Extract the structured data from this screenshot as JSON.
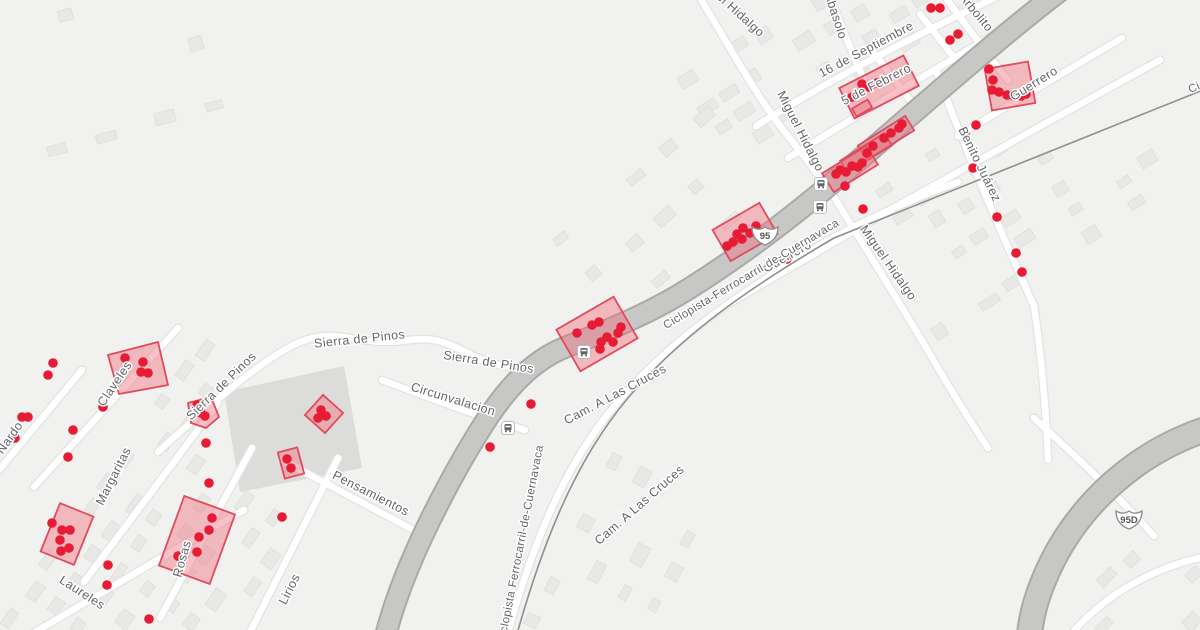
{
  "map": {
    "colors": {
      "land": "#f1f1f0",
      "building": "#e8e8e7",
      "building_stroke": "#dededc",
      "plaza": "#dcdcda",
      "minor": "#ffffff",
      "minor_casing": "#e3e3e1",
      "major": "#c7c7c6",
      "major_casing": "#a9a9a8",
      "rail": "#8f8f8e",
      "marker": "#e81b35",
      "highlight_fill": "#f0697a",
      "highlight_stroke": "#e24b5e",
      "label": "#63666a",
      "halo": "#ffffff",
      "shield_fill": "#ffffff",
      "shield_stroke": "#8f8f8f",
      "shield_text": "#555555",
      "bus_fill": "#ffffff",
      "bus_stroke": "#bdbdbd",
      "bus_glyph": "#5f6368"
    },
    "street_labels": [
      {
        "t": "Sierra de Pinos",
        "x": 224,
        "y": 389,
        "r": -44
      },
      {
        "t": "Sierra de Pinos",
        "x": 360,
        "y": 343,
        "r": -6
      },
      {
        "t": "Sierra de Pinos",
        "x": 488,
        "y": 366,
        "r": 9
      },
      {
        "t": "Circunvalacion",
        "x": 452,
        "y": 403,
        "r": 17
      },
      {
        "t": "Pensamientos",
        "x": 369,
        "y": 497,
        "r": 27
      },
      {
        "t": "Margaritas",
        "x": 117,
        "y": 478,
        "r": -63
      },
      {
        "t": "Claveles",
        "x": 118,
        "y": 386,
        "r": -56
      },
      {
        "t": "Nardo",
        "x": 13,
        "y": 440,
        "r": -55
      },
      {
        "t": "Laureles",
        "x": 80,
        "y": 596,
        "r": 33
      },
      {
        "t": "Lirios",
        "x": 293,
        "y": 591,
        "r": -63
      },
      {
        "t": "Rosas",
        "x": 186,
        "y": 560,
        "r": -74
      },
      {
        "t": "Miguel Hidalgo",
        "x": 727,
        "y": 8,
        "r": 42
      },
      {
        "t": "Miguel Hidalgo",
        "x": 797,
        "y": 133,
        "r": 63
      },
      {
        "t": "Miguel Hidalgo",
        "x": 885,
        "y": 265,
        "r": 55
      },
      {
        "t": "Guerrero",
        "x": 789,
        "y": 260,
        "r": -29
      },
      {
        "t": "Guerrero",
        "x": 1036,
        "y": 87,
        "r": -32
      },
      {
        "t": "Benito Juárez",
        "x": 976,
        "y": 166,
        "r": 64
      },
      {
        "t": "16 de Septiembre",
        "x": 868,
        "y": 53,
        "r": -28
      },
      {
        "t": "5 de Febrero",
        "x": 878,
        "y": 88,
        "r": -27
      },
      {
        "t": "Arbolito",
        "x": 973,
        "y": 15,
        "r": 50
      },
      {
        "t": "Abasolo",
        "x": 832,
        "y": 17,
        "r": 72
      },
      {
        "t": "Cam. A Las Cruces",
        "x": 617,
        "y": 398,
        "r": -28
      },
      {
        "t": "Cam. A Las Cruces",
        "x": 642,
        "y": 508,
        "r": -41
      },
      {
        "t": "Ciclopista-Ferrocarril-de-Cuernavaca",
        "x": 753,
        "y": 277,
        "r": -31,
        "s": 11.5
      },
      {
        "t": "Ciclopista Ferrocarril-de-Cuernavaca",
        "x": 524,
        "y": 545,
        "r": -79,
        "s": 11.5
      },
      {
        "t": "Ciclopista-Ferrocarril-de-Cuernavaca",
        "x": 1283,
        "y": 52,
        "r": -24,
        "s": 11.5
      }
    ],
    "shields": [
      {
        "label": "95",
        "x": 765,
        "y": 234
      },
      {
        "label": "95D",
        "x": 1129,
        "y": 518
      }
    ],
    "bus_stops": [
      [
        821,
        184
      ],
      [
        820,
        207
      ],
      [
        584,
        352
      ],
      [
        508,
        428
      ]
    ],
    "highlights": [
      {
        "cx": 879,
        "cy": 87,
        "w": 72,
        "h": 34,
        "r": -27
      },
      {
        "cx": 1010,
        "cy": 86,
        "w": 44,
        "h": 42,
        "r": -10
      },
      {
        "cx": 886,
        "cy": 138,
        "w": 56,
        "h": 17,
        "r": -32
      },
      {
        "cx": 866,
        "cy": 153,
        "w": 52,
        "h": 14,
        "r": -32
      },
      {
        "cx": 850,
        "cy": 169,
        "w": 52,
        "h": 22,
        "r": -32
      },
      {
        "cx": 862,
        "cy": 108,
        "w": 18,
        "h": 9,
        "r": -30
      },
      {
        "cx": 745,
        "cy": 232,
        "w": 54,
        "h": 36,
        "r": -30
      },
      {
        "cx": 597,
        "cy": 334,
        "w": 66,
        "h": 48,
        "r": -30
      },
      {
        "pts": "108,355 158,342 168,385 119,394"
      },
      {
        "pts": "188,403 211,397 219,417 206,428 191,423"
      },
      {
        "cx": 324,
        "cy": 414,
        "w": 27,
        "h": 27,
        "r": 42
      },
      {
        "cx": 291,
        "cy": 463,
        "w": 20,
        "h": 27,
        "r": -15
      },
      {
        "cx": 67,
        "cy": 534,
        "w": 36,
        "h": 52,
        "r": 22
      },
      {
        "cx": 197,
        "cy": 540,
        "w": 54,
        "h": 74,
        "r": 20
      }
    ],
    "markers": [
      [
        931,
        8
      ],
      [
        940,
        8
      ],
      [
        950,
        40
      ],
      [
        958,
        34
      ],
      [
        862,
        84
      ],
      [
        869,
        87
      ],
      [
        877,
        83
      ],
      [
        852,
        97
      ],
      [
        989,
        69
      ],
      [
        993,
        80
      ],
      [
        992,
        90
      ],
      [
        999,
        92
      ],
      [
        1007,
        95
      ],
      [
        1014,
        96
      ],
      [
        1021,
        96
      ],
      [
        1026,
        94
      ],
      [
        873,
        146
      ],
      [
        884,
        138
      ],
      [
        891,
        133
      ],
      [
        899,
        128
      ],
      [
        902,
        124
      ],
      [
        867,
        153
      ],
      [
        836,
        174
      ],
      [
        840,
        170
      ],
      [
        846,
        172
      ],
      [
        852,
        166
      ],
      [
        858,
        167
      ],
      [
        862,
        163
      ],
      [
        845,
        186
      ],
      [
        863,
        209
      ],
      [
        965,
        133
      ],
      [
        976,
        125
      ],
      [
        973,
        168
      ],
      [
        997,
        217
      ],
      [
        1016,
        253
      ],
      [
        1022,
        272
      ],
      [
        787,
        259
      ],
      [
        727,
        246
      ],
      [
        733,
        242
      ],
      [
        737,
        234
      ],
      [
        743,
        228
      ],
      [
        742,
        239
      ],
      [
        750,
        233
      ],
      [
        756,
        226
      ],
      [
        577,
        333
      ],
      [
        592,
        325
      ],
      [
        599,
        322
      ],
      [
        601,
        342
      ],
      [
        607,
        337
      ],
      [
        613,
        342
      ],
      [
        618,
        333
      ],
      [
        600,
        349
      ],
      [
        621,
        327
      ],
      [
        531,
        404
      ],
      [
        490,
        447
      ],
      [
        125,
        358
      ],
      [
        143,
        362
      ],
      [
        141,
        372
      ],
      [
        148,
        373
      ],
      [
        103,
        407
      ],
      [
        53,
        363
      ],
      [
        48,
        375
      ],
      [
        22,
        417
      ],
      [
        28,
        417
      ],
      [
        15,
        438
      ],
      [
        73,
        430
      ],
      [
        68,
        457
      ],
      [
        197,
        405
      ],
      [
        201,
        413
      ],
      [
        205,
        416
      ],
      [
        206,
        443
      ],
      [
        209,
        483
      ],
      [
        321,
        410
      ],
      [
        318,
        418
      ],
      [
        326,
        416
      ],
      [
        287,
        459
      ],
      [
        291,
        468
      ],
      [
        108,
        565
      ],
      [
        107,
        585
      ],
      [
        212,
        518
      ],
      [
        209,
        530
      ],
      [
        199,
        537
      ],
      [
        197,
        552
      ],
      [
        178,
        556
      ],
      [
        52,
        523
      ],
      [
        62,
        530
      ],
      [
        70,
        530
      ],
      [
        60,
        540
      ],
      [
        69,
        548
      ],
      [
        61,
        551
      ],
      [
        282,
        517
      ],
      [
        149,
        619
      ]
    ]
  }
}
